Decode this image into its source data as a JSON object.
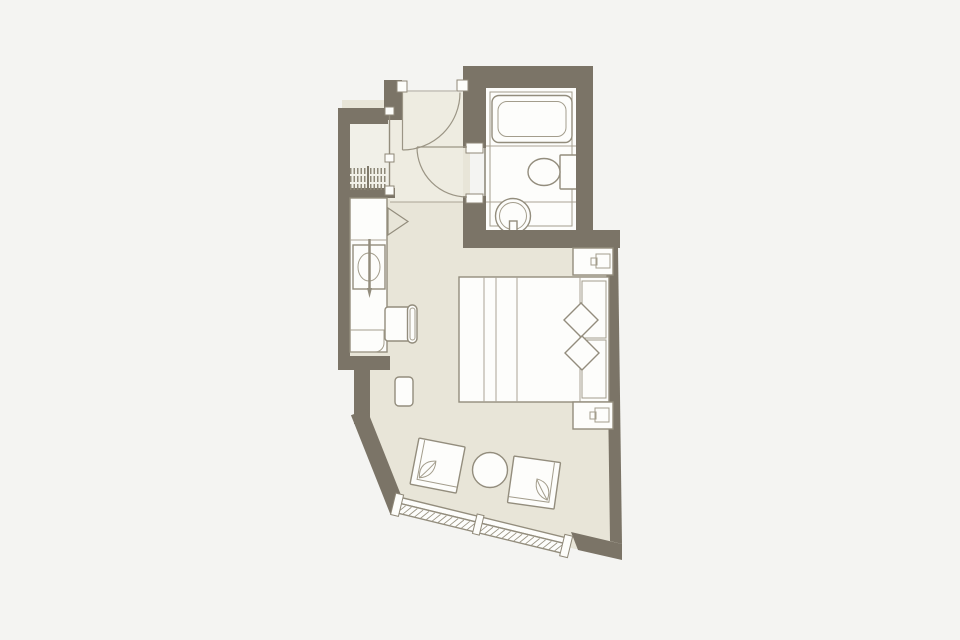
{
  "document": {
    "kind": "hotel-guestroom-floor-plan",
    "visible_text": [],
    "colors": {
      "page_background": "#f4f4f2",
      "wall": "#7b7467",
      "bedroom_floor": "#e8e5d8",
      "hall_floor": "#eeece1",
      "closet_floor": "#f1f0e8",
      "bathroom_floor": "#fdfdfb",
      "outline": "#938d7d"
    },
    "rooms": [
      {
        "name": "bathroom",
        "fixtures": [
          "bathtub",
          "toilet",
          "round-washbasin"
        ]
      },
      {
        "name": "entry-hall",
        "features": [
          "entry-door-swing",
          "bathroom-door-swing"
        ]
      },
      {
        "name": "closet",
        "features": [
          "hanger-shelves",
          "sliding-front"
        ]
      },
      {
        "name": "bedroom",
        "furniture": [
          "minibar-counter",
          "counter-basin",
          "desk-chair",
          "luggage-stool",
          "double-bed",
          "pillow",
          "pillow",
          "nightstand-top",
          "nightstand-bottom",
          "armchair-left",
          "armchair-right",
          "round-coffee-table",
          "panorama-window"
        ]
      }
    ]
  }
}
